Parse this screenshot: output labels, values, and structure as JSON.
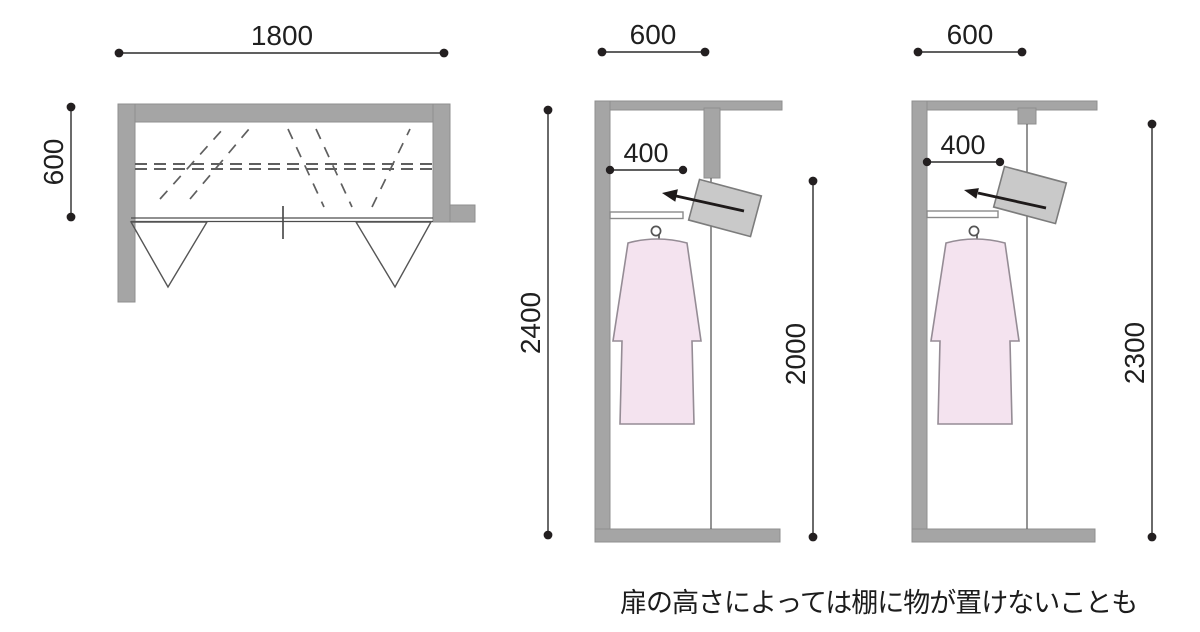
{
  "figure": {
    "caption": "扉の高さによっては棚に物が置けないことも"
  },
  "colors": {
    "wall": "#a5a5a5",
    "wall_edge": "#8f8f8f",
    "box_fill": "#c9c9c9",
    "box_stroke": "#7c7c7c",
    "dress_fill": "#f4e3ef",
    "dress_stroke": "#958c95",
    "arrow": "#1e1a1a",
    "dashed_line": "#5f5f5f",
    "door_line": "#666666",
    "shelf_fill": "#ffffff",
    "shelf_stroke": "#8a8a8a"
  },
  "plan": {
    "width": "1800",
    "depth": "600"
  },
  "section_low": {
    "depth": "600",
    "shelf_depth": "400",
    "total_height": "2400",
    "door_height": "2000"
  },
  "section_high": {
    "depth": "600",
    "shelf_depth": "400",
    "door_height": "2300"
  }
}
